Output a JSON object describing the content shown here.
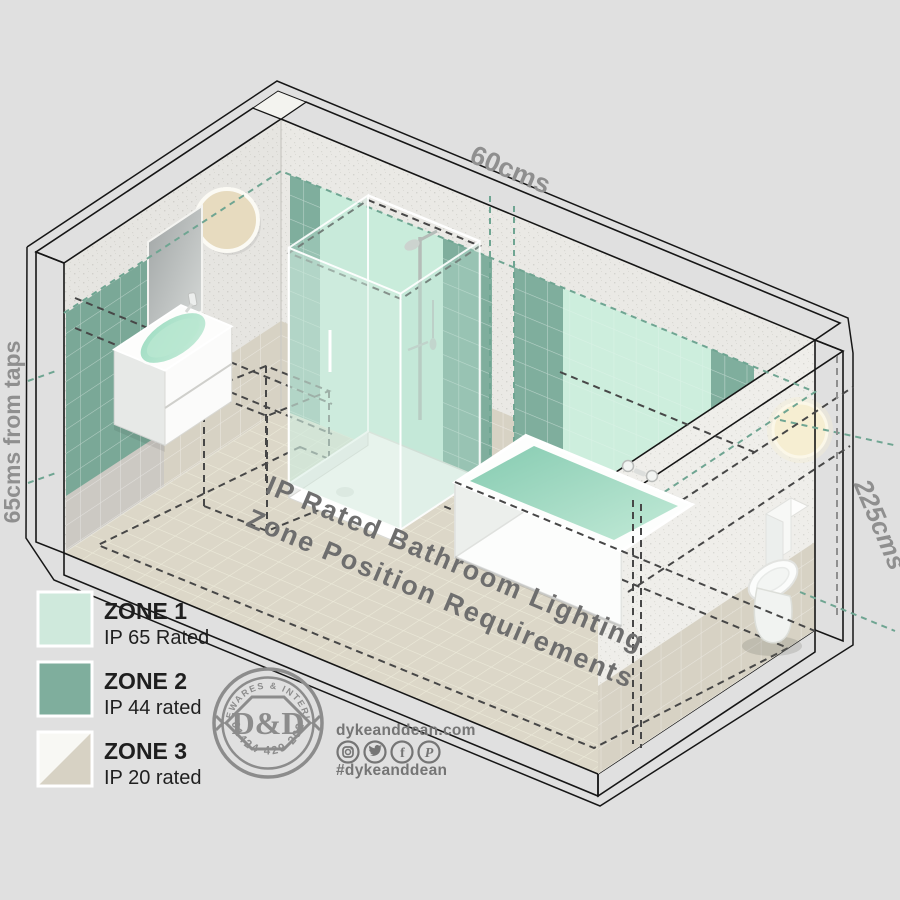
{
  "colors": {
    "background": "#e0e0e0",
    "zone1": "#cfe9dc",
    "zone2": "#7fae9d",
    "zone3_light": "#f8f8f4",
    "zone3_beige": "#d7d2c4",
    "accent_teal": "#6fa592",
    "label_gray": "#8f8f8f",
    "floor_text_gray": "#6e6e6e",
    "logo_gray": "#8c8c8c"
  },
  "measurements": {
    "top": "60cms",
    "left": "65cms from taps",
    "right": "225cms"
  },
  "floor_title": {
    "line1": "IP Rated Bathroom Lighting",
    "line2": "Zone Position Requirements"
  },
  "legend": {
    "items": [
      {
        "zone": "ZONE 1",
        "rating": "IP 65 Rated",
        "color": "#cfe9dc"
      },
      {
        "zone": "ZONE 2",
        "rating": "IP 44 rated",
        "color": "#7fae9d"
      },
      {
        "zone": "ZONE 3",
        "rating": "IP 20 rated",
        "color": "#f8f8f4",
        "color2": "#d7d2c4"
      }
    ]
  },
  "branding": {
    "stamp_top": "HOMEWARES & INTERIORS",
    "stamp_monogram": "D&D",
    "stamp_phone": "01424 429 202",
    "website": "dykeanddean.com",
    "hashtag": "#dykeanddean",
    "social_icons": [
      "instagram",
      "twitter",
      "facebook",
      "pinterest"
    ],
    "icon_glyphs": {
      "facebook": "f",
      "pinterest": "P"
    }
  }
}
